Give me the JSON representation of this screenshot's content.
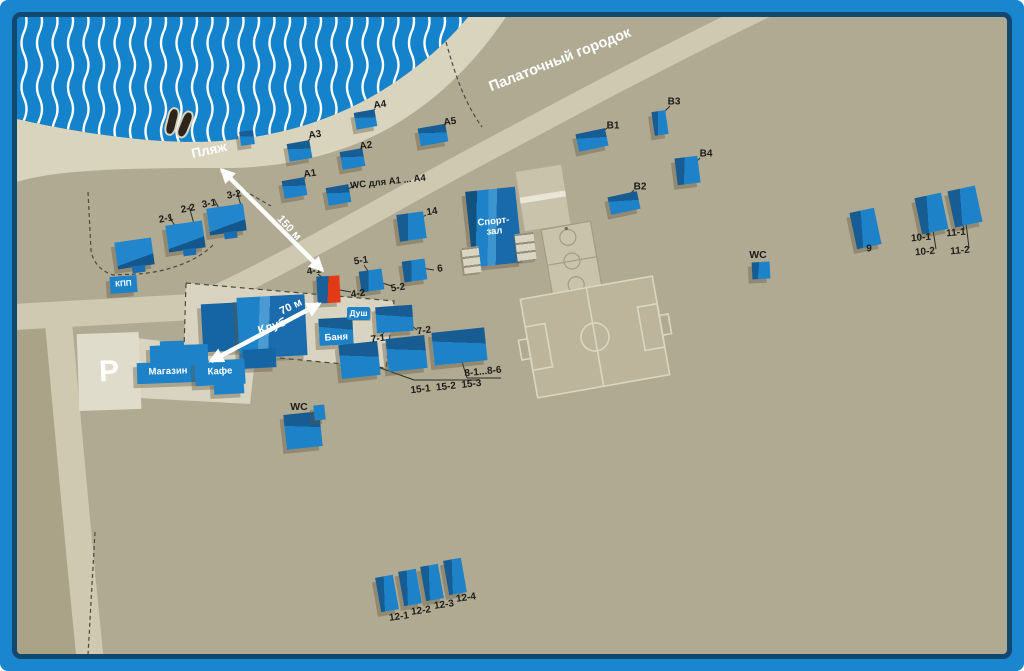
{
  "colors": {
    "frame": "#1a86cf",
    "frameDark": "#11486e",
    "water": "#1583cb",
    "wave": "#ffffff",
    "terrain": "#b1aa92",
    "terrainDark": "#aaa388",
    "beach": "#d9d4be",
    "road": "#cfc9b2",
    "plaza": "#d8d4c1",
    "parking": "#e0dccb",
    "bldBright": "#1e82c8",
    "bldDark": "#175c92",
    "red": "#e23a15",
    "labelInk": "#1c1c1a",
    "dash": "#4c483c",
    "court": "#c9c3ab",
    "courtLine": "#a29c83",
    "field": "#bcb59c",
    "fieldLine": "#dad6c0"
  },
  "map": {
    "area_labels": [
      {
        "id": "beach",
        "text": "Пляж",
        "x": 209,
        "y": 150,
        "rot": -12,
        "size": 13.5
      },
      {
        "id": "tent-city",
        "text": "Палаточный городок",
        "x": 560,
        "y": 60,
        "rot": -21.5,
        "size": 14.5
      },
      {
        "id": "parking",
        "text": "Р",
        "x": 106,
        "y": 369,
        "rot": 0,
        "size": 30
      }
    ],
    "arrows": [
      {
        "id": "arrow-150m",
        "text": "150 м",
        "x1": 322,
        "y1": 270,
        "x2": 222,
        "y2": 170,
        "double": true,
        "lx": 289,
        "ly": 228,
        "lrot": 47
      },
      {
        "id": "arrow-70m",
        "text": "70 м",
        "x1": 211,
        "y1": 361,
        "x2": 319,
        "y2": 304,
        "double": true,
        "lx": 291,
        "ly": 307,
        "lrot": -26
      }
    ],
    "labels": [
      {
        "id": "a1",
        "text": "A1",
        "x": 310,
        "y": 174,
        "rot": -8,
        "size": 10
      },
      {
        "id": "a2",
        "text": "A2",
        "x": 366,
        "y": 146,
        "rot": -8,
        "size": 10
      },
      {
        "id": "a3",
        "text": "A3",
        "x": 315,
        "y": 135,
        "rot": -8,
        "size": 10
      },
      {
        "id": "a4",
        "text": "A4",
        "x": 380,
        "y": 105,
        "rot": -8,
        "size": 10
      },
      {
        "id": "a5",
        "text": "A5",
        "x": 450,
        "y": 122,
        "rot": -8,
        "size": 10
      },
      {
        "id": "wc-a",
        "text": "WC для A1 ... A4",
        "x": 388,
        "y": 182,
        "rot": -6,
        "size": 9.5
      },
      {
        "id": "l2-1",
        "text": "2-1",
        "x": 166,
        "y": 219,
        "rot": -10,
        "size": 10
      },
      {
        "id": "l2-2",
        "text": "2-2",
        "x": 188,
        "y": 209,
        "rot": -10,
        "size": 10
      },
      {
        "id": "l3-1",
        "text": "3-1",
        "x": 209,
        "y": 204,
        "rot": -10,
        "size": 10
      },
      {
        "id": "l3-2",
        "text": "3-2",
        "x": 234,
        "y": 195,
        "rot": -10,
        "size": 10
      },
      {
        "id": "l14",
        "text": "14",
        "x": 432,
        "y": 212,
        "rot": -8,
        "size": 10
      },
      {
        "id": "l5-1",
        "text": "5-1",
        "x": 361,
        "y": 261,
        "rot": -8,
        "size": 10
      },
      {
        "id": "l5-2",
        "text": "5-2",
        "x": 398,
        "y": 288,
        "rot": -8,
        "size": 10
      },
      {
        "id": "l6",
        "text": "6",
        "x": 440,
        "y": 269,
        "rot": -8,
        "size": 10
      },
      {
        "id": "l4-1",
        "text": "4-1",
        "x": 314,
        "y": 271,
        "rot": -8,
        "size": 10
      },
      {
        "id": "l4-2",
        "text": "4-2",
        "x": 358,
        "y": 294,
        "rot": -8,
        "size": 10
      },
      {
        "id": "l7-1",
        "text": "7-1",
        "x": 378,
        "y": 339,
        "rot": -8,
        "size": 10
      },
      {
        "id": "l7-2",
        "text": "7-2",
        "x": 424,
        "y": 331,
        "rot": -8,
        "size": 10
      },
      {
        "id": "l8",
        "text": "8-1...8-6",
        "x": 483,
        "y": 372,
        "rot": -6,
        "size": 10
      },
      {
        "id": "l15",
        "text": "15-1  15-2  15-3",
        "x": 446,
        "y": 387,
        "rot": -6,
        "size": 10
      },
      {
        "id": "l12-1",
        "text": "12-1",
        "x": 399,
        "y": 617,
        "rot": -8,
        "size": 10
      },
      {
        "id": "l12-2",
        "text": "12-2",
        "x": 421,
        "y": 611,
        "rot": -8,
        "size": 10
      },
      {
        "id": "l12-3",
        "text": "12-3",
        "x": 444,
        "y": 605,
        "rot": -8,
        "size": 10
      },
      {
        "id": "l12-4",
        "text": "12-4",
        "x": 466,
        "y": 598,
        "rot": -8,
        "size": 10
      },
      {
        "id": "l9",
        "text": "9",
        "x": 869,
        "y": 249,
        "rot": 0,
        "size": 10
      },
      {
        "id": "l10-1",
        "text": "10-1",
        "x": 921,
        "y": 238,
        "rot": -5,
        "size": 10
      },
      {
        "id": "l10-2",
        "text": "10-2",
        "x": 925,
        "y": 252,
        "rot": -5,
        "size": 10
      },
      {
        "id": "l11-1",
        "text": "11-1",
        "x": 956,
        "y": 233,
        "rot": -5,
        "size": 10
      },
      {
        "id": "l11-2",
        "text": "11-2",
        "x": 960,
        "y": 251,
        "rot": -5,
        "size": 10
      },
      {
        "id": "lb1",
        "text": "B1",
        "x": 613,
        "y": 126,
        "rot": 0,
        "size": 10
      },
      {
        "id": "lb2",
        "text": "B2",
        "x": 640,
        "y": 187,
        "rot": 0,
        "size": 10
      },
      {
        "id": "lb3",
        "text": "B3",
        "x": 674,
        "y": 102,
        "rot": 0,
        "size": 10
      },
      {
        "id": "lb4",
        "text": "B4",
        "x": 706,
        "y": 154,
        "rot": 0,
        "size": 10
      },
      {
        "id": "lwc-r",
        "text": "WC",
        "x": 758,
        "y": 255,
        "rot": 0,
        "size": 10.5
      },
      {
        "id": "lwc-l",
        "text": "WC",
        "x": 299,
        "y": 407,
        "rot": 0,
        "size": 10.5
      }
    ],
    "buildings": [
      {
        "id": "kpp",
        "x": 110,
        "y": 276,
        "w": 27,
        "h": 17,
        "rot": -4,
        "kind": "flat",
        "text": "КПП",
        "tsize": 8
      },
      {
        "id": "a1",
        "x": 283,
        "y": 179,
        "w": 23,
        "h": 18,
        "rot": -10,
        "kind": "h"
      },
      {
        "id": "a2",
        "x": 341,
        "y": 150,
        "w": 23,
        "h": 18,
        "rot": -10,
        "kind": "h"
      },
      {
        "id": "a3",
        "x": 288,
        "y": 142,
        "w": 23,
        "h": 18,
        "rot": -10,
        "kind": "h"
      },
      {
        "id": "a4",
        "x": 355,
        "y": 111,
        "w": 21,
        "h": 17,
        "rot": -10,
        "kind": "h"
      },
      {
        "id": "a5",
        "x": 419,
        "y": 126,
        "w": 28,
        "h": 18,
        "rot": -10,
        "kind": "h"
      },
      {
        "id": "wc-a",
        "x": 327,
        "y": 186,
        "w": 23,
        "h": 18,
        "rot": -10,
        "kind": "h"
      },
      {
        "id": "house-1",
        "x": 116,
        "y": 240,
        "w": 37,
        "h": 27,
        "rot": -8,
        "kind": "house"
      },
      {
        "id": "house-2",
        "x": 167,
        "y": 223,
        "w": 37,
        "h": 27,
        "rot": -8,
        "kind": "house"
      },
      {
        "id": "house-3",
        "x": 208,
        "y": 206,
        "w": 37,
        "h": 27,
        "rot": -8,
        "kind": "house"
      },
      {
        "id": "b14",
        "x": 398,
        "y": 213,
        "w": 27,
        "h": 27,
        "rot": -8,
        "kind": "v"
      },
      {
        "id": "b5",
        "x": 360,
        "y": 270,
        "w": 23,
        "h": 21,
        "rot": -8,
        "kind": "v"
      },
      {
        "id": "b6",
        "x": 403,
        "y": 260,
        "w": 23,
        "h": 21,
        "rot": -8,
        "kind": "v"
      },
      {
        "id": "b4",
        "x": 317,
        "y": 276,
        "w": 23,
        "h": 27,
        "rot": -3,
        "kind": "red"
      },
      {
        "id": "gym",
        "x": 469,
        "y": 189,
        "w": 50,
        "h": 76,
        "rot": -6,
        "kind": "gym",
        "text": "Спорт-\nзал",
        "tsize": 9.5
      },
      {
        "id": "bench-l",
        "x": 463,
        "y": 247,
        "w": 17,
        "h": 26,
        "rot": -7,
        "kind": "pale"
      },
      {
        "id": "bench-r",
        "x": 516,
        "y": 233,
        "w": 19,
        "h": 28,
        "rot": -7,
        "kind": "pale"
      },
      {
        "id": "club-a",
        "x": 202,
        "y": 303,
        "w": 50,
        "h": 48,
        "rot": -3,
        "kind": "clubdark"
      },
      {
        "id": "club-b",
        "x": 238,
        "y": 296,
        "w": 68,
        "h": 61,
        "rot": -3,
        "kind": "club",
        "text": "Клуб",
        "tsize": 12,
        "trot": -16
      },
      {
        "id": "club-c",
        "x": 243,
        "y": 349,
        "w": 33,
        "h": 19,
        "rot": -3,
        "kind": "clubdark"
      },
      {
        "id": "mag-annex",
        "x": 160,
        "y": 341,
        "w": 24,
        "h": 11,
        "rot": -2,
        "kind": "flat"
      },
      {
        "id": "magazin-main",
        "x": 150,
        "y": 345,
        "w": 58,
        "h": 21,
        "rot": -2,
        "kind": "flat"
      },
      {
        "id": "magazin",
        "x": 137,
        "y": 362,
        "w": 62,
        "h": 21,
        "rot": -2,
        "kind": "flat",
        "text": "Магазин",
        "tsize": 9.5
      },
      {
        "id": "kafe",
        "x": 195,
        "y": 360,
        "w": 50,
        "h": 25,
        "rot": -3,
        "kind": "flat",
        "text": "Кафе",
        "tsize": 9.5
      },
      {
        "id": "kafe-ext",
        "x": 214,
        "y": 381,
        "w": 30,
        "h": 13,
        "rot": -3,
        "kind": "flat"
      },
      {
        "id": "banya",
        "x": 319,
        "y": 318,
        "w": 34,
        "h": 27,
        "rot": -3,
        "kind": "h",
        "text": "Баня",
        "tsize": 9.5,
        "tpos": "bottom"
      },
      {
        "id": "dush",
        "x": 347,
        "y": 307,
        "w": 23,
        "h": 13,
        "rot": 0,
        "kind": "badge",
        "text": "Душ",
        "tsize": 8.5
      },
      {
        "id": "b7",
        "x": 376,
        "y": 306,
        "w": 37,
        "h": 26,
        "rot": -4,
        "kind": "h"
      },
      {
        "id": "b15a",
        "x": 340,
        "y": 343,
        "w": 39,
        "h": 34,
        "rot": -6,
        "kind": "h"
      },
      {
        "id": "b15b",
        "x": 387,
        "y": 337,
        "w": 39,
        "h": 33,
        "rot": -6,
        "kind": "h"
      },
      {
        "id": "b8",
        "x": 433,
        "y": 330,
        "w": 53,
        "h": 33,
        "rot": -6,
        "kind": "h"
      },
      {
        "id": "wc-left",
        "x": 285,
        "y": 413,
        "w": 36,
        "h": 35,
        "rot": -6,
        "kind": "h"
      },
      {
        "id": "wc-left-annex",
        "x": 314,
        "y": 405,
        "w": 11,
        "h": 15,
        "rot": -6,
        "kind": "flat"
      },
      {
        "id": "b12-1",
        "x": 378,
        "y": 576,
        "w": 18,
        "h": 35,
        "rot": -10,
        "kind": "v"
      },
      {
        "id": "b12-2",
        "x": 401,
        "y": 570,
        "w": 18,
        "h": 35,
        "rot": -10,
        "kind": "v"
      },
      {
        "id": "b12-3",
        "x": 423,
        "y": 565,
        "w": 18,
        "h": 35,
        "rot": -10,
        "kind": "v"
      },
      {
        "id": "b12-4",
        "x": 446,
        "y": 559,
        "w": 18,
        "h": 35,
        "rot": -10,
        "kind": "v"
      },
      {
        "id": "b9",
        "x": 853,
        "y": 210,
        "w": 25,
        "h": 37,
        "rot": -12,
        "kind": "v"
      },
      {
        "id": "b10",
        "x": 918,
        "y": 195,
        "w": 27,
        "h": 37,
        "rot": -12,
        "kind": "v"
      },
      {
        "id": "b11",
        "x": 951,
        "y": 188,
        "w": 28,
        "h": 37,
        "rot": -12,
        "kind": "v"
      },
      {
        "id": "bB1",
        "x": 577,
        "y": 131,
        "w": 30,
        "h": 18,
        "rot": -12,
        "kind": "h"
      },
      {
        "id": "bB2",
        "x": 609,
        "y": 194,
        "w": 30,
        "h": 18,
        "rot": -12,
        "kind": "h"
      },
      {
        "id": "bB3",
        "x": 653,
        "y": 111,
        "w": 14,
        "h": 24,
        "rot": -8,
        "kind": "v"
      },
      {
        "id": "bB4",
        "x": 676,
        "y": 157,
        "w": 23,
        "h": 27,
        "rot": -7,
        "kind": "v"
      },
      {
        "id": "wc-right",
        "x": 752,
        "y": 262,
        "w": 18,
        "h": 17,
        "rot": -3,
        "kind": "v"
      },
      {
        "id": "beach-hut",
        "x": 240,
        "y": 131,
        "w": 14,
        "h": 14,
        "rot": -8,
        "kind": "h"
      },
      {
        "id": "boat-1",
        "x": 166,
        "y": 107,
        "w": 8,
        "h": 25,
        "rot": 14,
        "kind": "boat"
      },
      {
        "id": "boat-2",
        "x": 179,
        "y": 110,
        "w": 8,
        "h": 25,
        "rot": 22,
        "kind": "boat"
      }
    ]
  }
}
